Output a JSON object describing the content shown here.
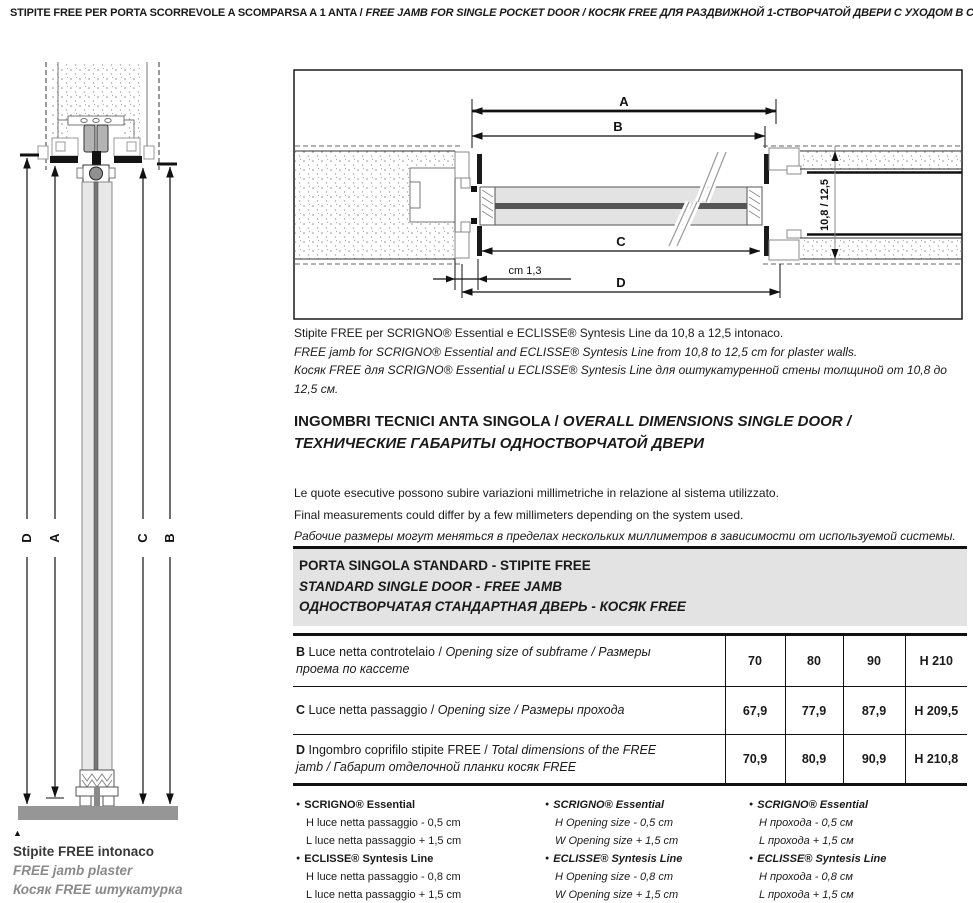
{
  "header": {
    "it": "STIPITE FREE PER PORTA SCORREVOLE A SCOMPARSA A 1 ANTA",
    "en": "FREE JAMB FOR SINGLE POCKET DOOR",
    "ru": "КОСЯК FREE ДЛЯ РАЗДВИЖНОЙ 1-СТВОРЧАТОЙ ДВЕРИ С УХОДОМ В СТЕНУ",
    "sep": " / "
  },
  "left_figure": {
    "dim_labels": [
      "D",
      "A",
      "C",
      "B"
    ],
    "caption": {
      "pointer": "▲",
      "it_pre": "Stipite ",
      "it_bold": "FREE",
      "it_post": " intonaco",
      "en": "FREE jamb plaster",
      "ru": "Косяк FREE штукатурка"
    }
  },
  "right_figure": {
    "dim_a": "A",
    "dim_b": "B",
    "dim_c": "C",
    "dim_d": "D",
    "cm_label": "cm 1,3",
    "wall_thickness": "10,8 / 12,5",
    "caption": {
      "it": "Stipite FREE per SCRIGNO® Essential e ECLISSE® Syntesis Line da 10,8 a 12,5 intonaco.",
      "en": "FREE jamb for SCRIGNO® Essential and ECLISSE® Syntesis Line from 10,8 to 12,5 cm for plaster walls.",
      "ru": "Косяк FREE для SCRIGNO® Essential и ECLISSE® Syntesis Line для оштукатуренной стены толщиной от 10,8 до 12,5 см."
    }
  },
  "section": {
    "heading": {
      "it": "INGOMBRI TECNICI ANTA SINGOLA",
      "en": "OVERALL DIMENSIONS SINGLE DOOR",
      "ru": "ТЕХНИЧЕСКИЕ ГАБАРИТЫ ОДНОСТВОРЧАТОЙ ДВЕРИ",
      "sep": " / "
    },
    "notes": {
      "it": "Le quote esecutive possono subire variazioni millimetriche in relazione al sistema utilizzato.",
      "en": "Final measurements could differ by a few millimeters depending on the system used.",
      "ru": "Рабочие размеры могут меняться в пределах нескольких миллиметров в зависимости от используемой системы."
    }
  },
  "band": {
    "it": "PORTA SINGOLA STANDARD - STIPITE FREE",
    "en": "STANDARD SINGLE DOOR - FREE JAMB",
    "ru": "ОДНОСТВОРЧАТАЯ СТАНДАРТНАЯ ДВЕРЬ - КОСЯК FREE"
  },
  "table": {
    "rows": [
      {
        "key": "B",
        "it": "Luce netta controtelaio /",
        "enru": "Opening size of subframe / Размеры проема по кассете",
        "values": [
          "70",
          "80",
          "90",
          "H 210"
        ]
      },
      {
        "key": "C",
        "it": "Luce netta passaggio /",
        "enru": "Opening size / Размеры прохода",
        "values": [
          "67,9",
          "77,9",
          "87,9",
          "H 209,5"
        ]
      },
      {
        "key": "D",
        "it": "Ingombro coprifilo stipite FREE /",
        "enru": "Total dimensions of the FREE jamb / Габарит отделочной планки косяк FREE",
        "values": [
          "70,9",
          "80,9",
          "90,9",
          "H 210,8"
        ]
      }
    ]
  },
  "footnotes": {
    "bullet": "●",
    "cols": [
      {
        "groups": [
          {
            "title": "SCRIGNO® Essential",
            "lines": [
              "H luce netta passaggio - 0,5 cm",
              "L luce netta passaggio + 1,5 cm"
            ]
          },
          {
            "title": "ECLISSE® Syntesis Line",
            "lines": [
              "H luce netta passaggio - 0,8 cm",
              "L luce netta passaggio + 1,5 cm"
            ]
          }
        ]
      },
      {
        "groups": [
          {
            "title": "SCRIGNO® Essential",
            "lines": [
              "H Opening size - 0,5 cm",
              "W Opening size + 1,5 cm"
            ]
          },
          {
            "title": "ECLISSE® Syntesis Line",
            "lines": [
              "H Opening size - 0,8 cm",
              "W Opening size + 1,5 cm"
            ]
          }
        ]
      },
      {
        "groups": [
          {
            "title": "SCRIGNO® Essential",
            "lines": [
              "H прохода - 0,5 см",
              "L прохода + 1,5 см"
            ]
          },
          {
            "title": "ECLISSE® Syntesis Line",
            "lines": [
              "H прохода - 0,8 см",
              "L прохода + 1,5 см"
            ]
          }
        ]
      }
    ]
  },
  "colors": {
    "band_bg": "#e3e3e3",
    "muted_text": "#8a8a8a",
    "line": "#111111"
  }
}
